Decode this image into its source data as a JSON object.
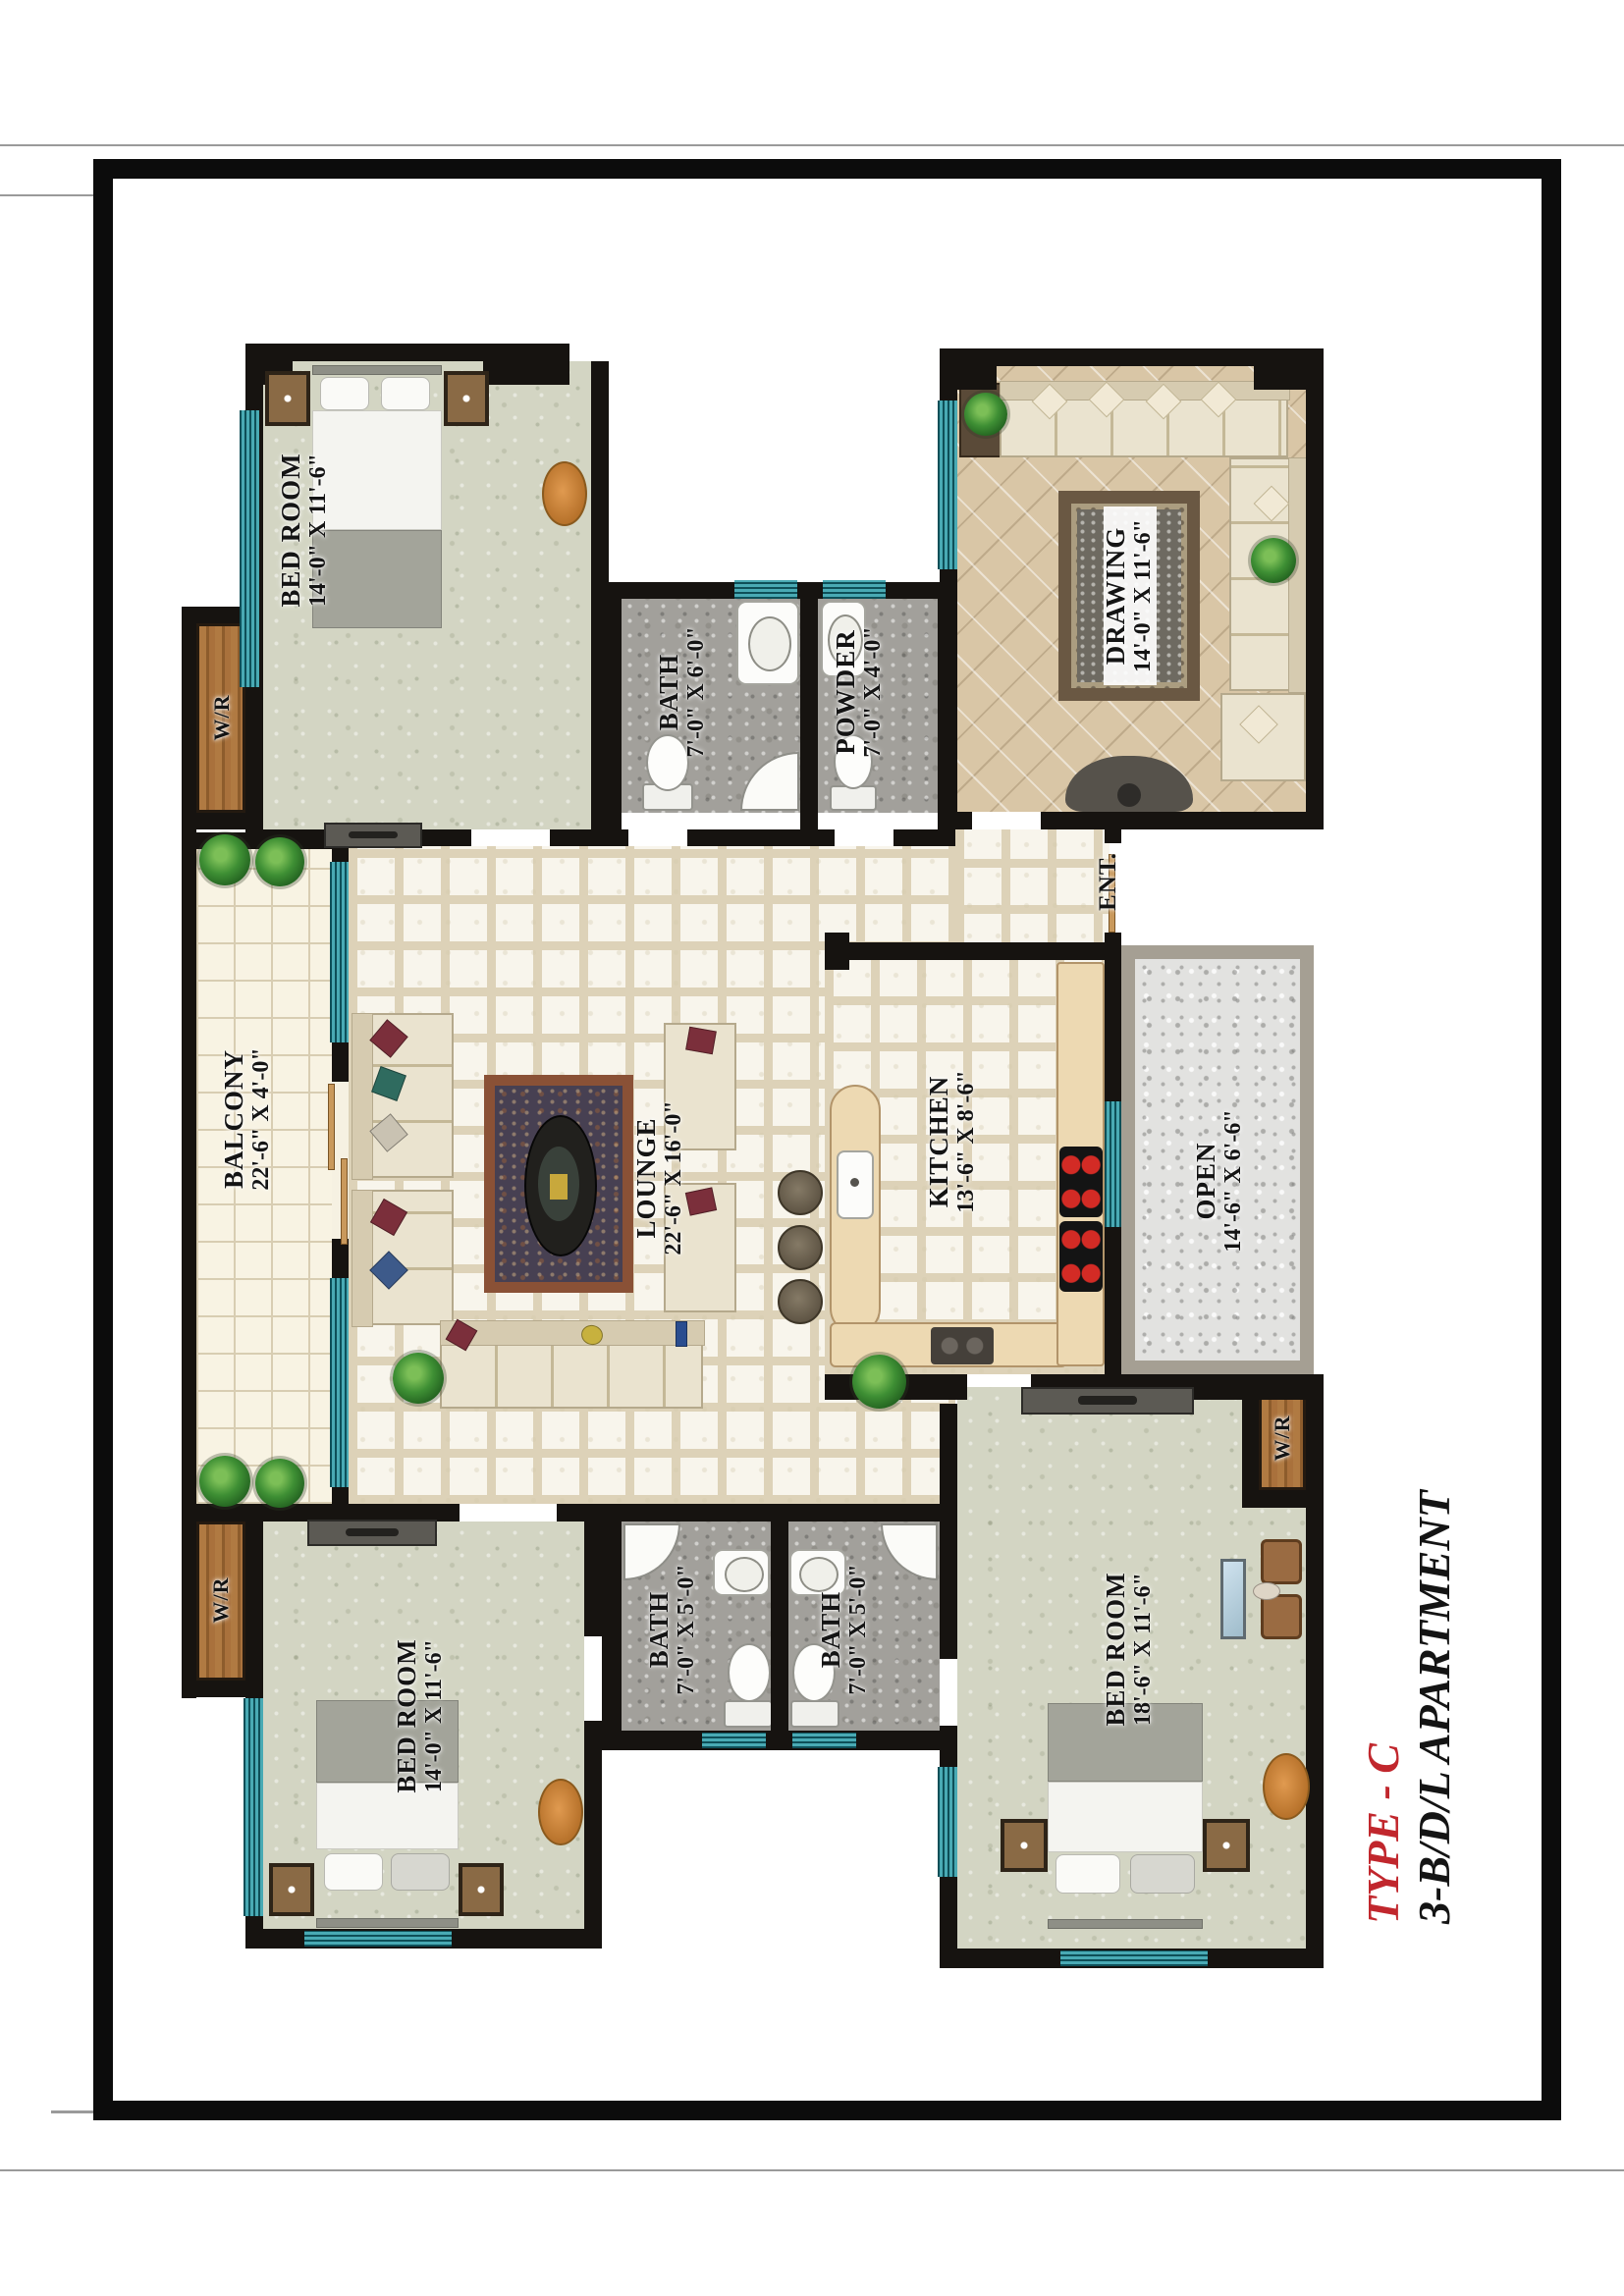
{
  "title_block": {
    "type_label": "TYPE - C",
    "apartment_label": "3-B/D/L APARTMENT"
  },
  "rooms": {
    "bedroom_top_left": {
      "name": "BED ROOM",
      "dims": "14'-0\" X 11'-6\""
    },
    "bath_top": {
      "name": "BATH",
      "dims": "7'-0\" X 6'-0\""
    },
    "powder": {
      "name": "POWDER",
      "dims": "7'-0\" X 4'-0\""
    },
    "drawing": {
      "name": "DRAWING",
      "dims": "14'-0\" X 11'-6\""
    },
    "balcony": {
      "name": "BALCONY",
      "dims": "22'-6\" X 4'-0\""
    },
    "lounge": {
      "name": "LOUNGE",
      "dims": "22'-6\" X 16'-0\""
    },
    "kitchen": {
      "name": "KITCHEN",
      "dims": "13'-6\" X 8'-6\""
    },
    "open": {
      "name": "OPEN",
      "dims": "14'-6\" X 6'-6\""
    },
    "bedroom_bottom_left": {
      "name": "BED ROOM",
      "dims": "14'-0\" X 11'-6\""
    },
    "bath_bottom_left": {
      "name": "BATH",
      "dims": "7'-0\" X 5'-0\""
    },
    "bath_bottom_right": {
      "name": "BATH",
      "dims": "7'-0\" X 5'-0\""
    },
    "bedroom_bottom_right": {
      "name": "BED ROOM",
      "dims": "18'-6\" X 11'-6\""
    },
    "wardrobe": {
      "name": "W/R"
    },
    "entrance": {
      "name": "ENT."
    }
  },
  "colors": {
    "title_red": "#c1272d",
    "wall_black": "#161310",
    "window_teal": "#3fa3ae",
    "wood_brown": "#a9713c",
    "sage_floor": "#d3d5c3",
    "tile_cream": "#f6f2e6",
    "drawing_tan": "#d9c6a6",
    "bath_gray": "#a2a09b"
  }
}
